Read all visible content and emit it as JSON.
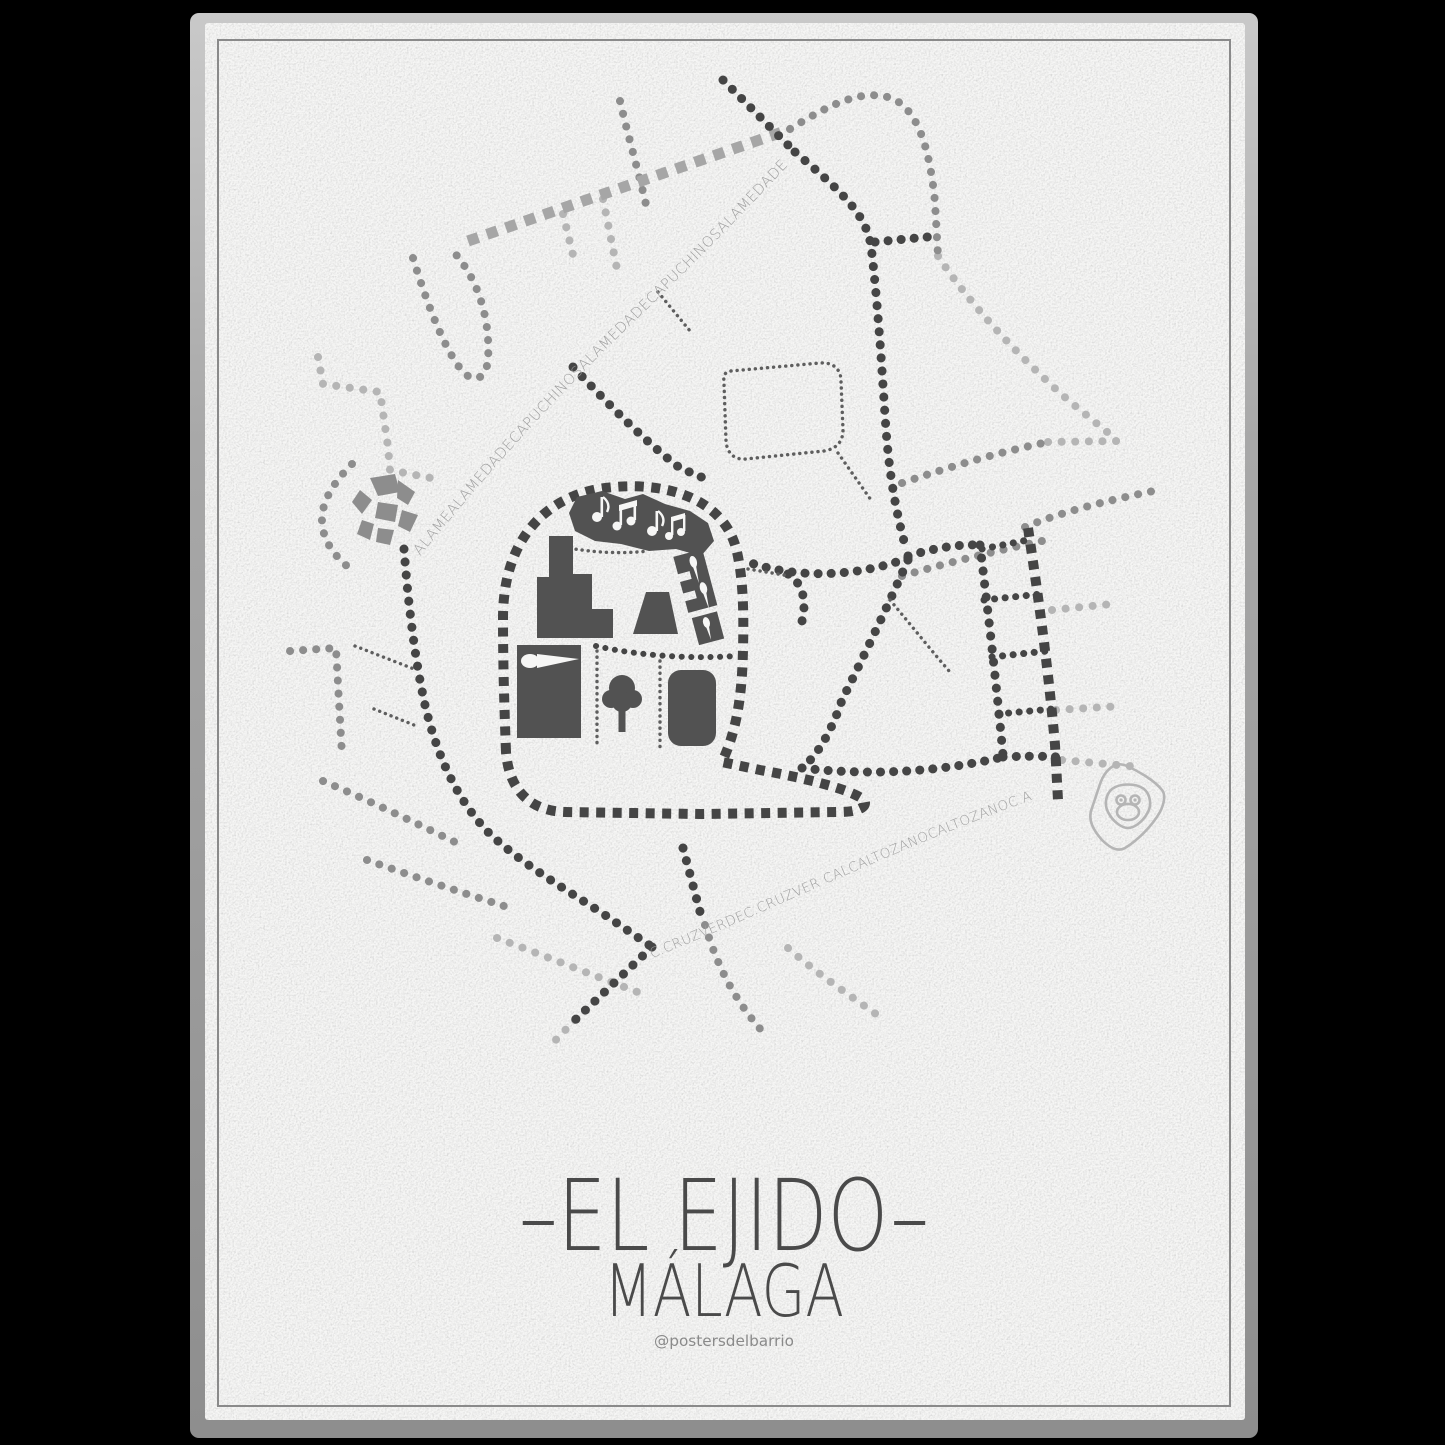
{
  "poster": {
    "title": "–EL EJIDO–",
    "subtitle": "MÁLAGA",
    "credit": "@postersdelbarrio"
  },
  "map": {
    "street_labels": {
      "alameda": "ALAMEALAMEDADECAPUCHINOSALAMEDADECAPUCHINOSALAMEDADE",
      "cruz_altozano": "C.CRUZVERDEC.CRUZVER CALCALTOZANOCALTOZANOC.A"
    },
    "icons": [
      "music-notes",
      "paintbrush",
      "tree",
      "monkey",
      "mosaic-plaza"
    ]
  },
  "colors": {
    "background": "#000000",
    "edge_top": "#c9c9c9",
    "edge_bottom": "#8e8e8e",
    "paper": "#f6f6f5",
    "border": "#8a8a8a",
    "ink_dark": "#454545",
    "ink_mid": "#8d8d8d",
    "ink_light": "#b5b5b5",
    "ink_fine": "#5e5e5e",
    "ink_sq_gray": "#a6a6a6",
    "building": "#525252",
    "label": "#9f9f9f",
    "title": "#4a4a4a",
    "credit": "#8a8a8a"
  }
}
